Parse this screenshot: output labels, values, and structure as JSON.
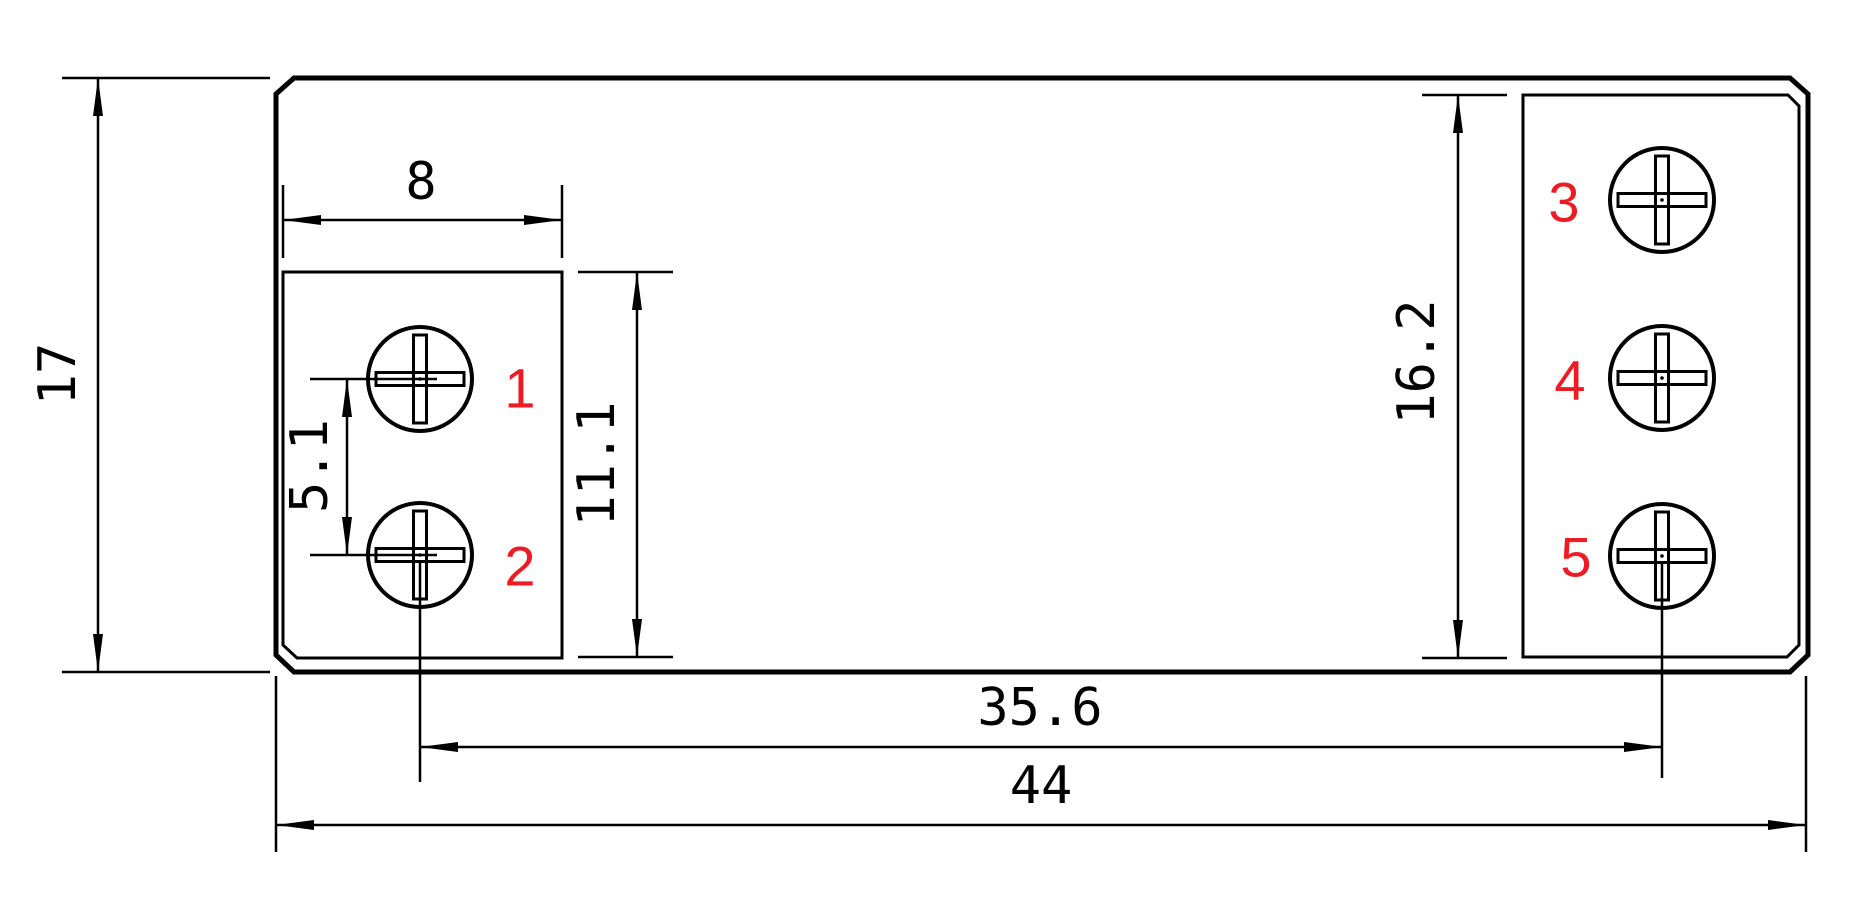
{
  "drawing": {
    "background": "#ffffff",
    "line_color": "#000000",
    "terminal_label_color": "#ed1c24"
  },
  "dimensions": {
    "overall_height": "17",
    "overall_width": "44",
    "left_block_width": "8",
    "left_pin_pitch": "5.1",
    "left_block_height": "11.1",
    "right_block_height": "16.2",
    "terminal_span": "35.6"
  },
  "terminals": {
    "t1": "1",
    "t2": "2",
    "t3": "3",
    "t4": "4",
    "t5": "5"
  }
}
